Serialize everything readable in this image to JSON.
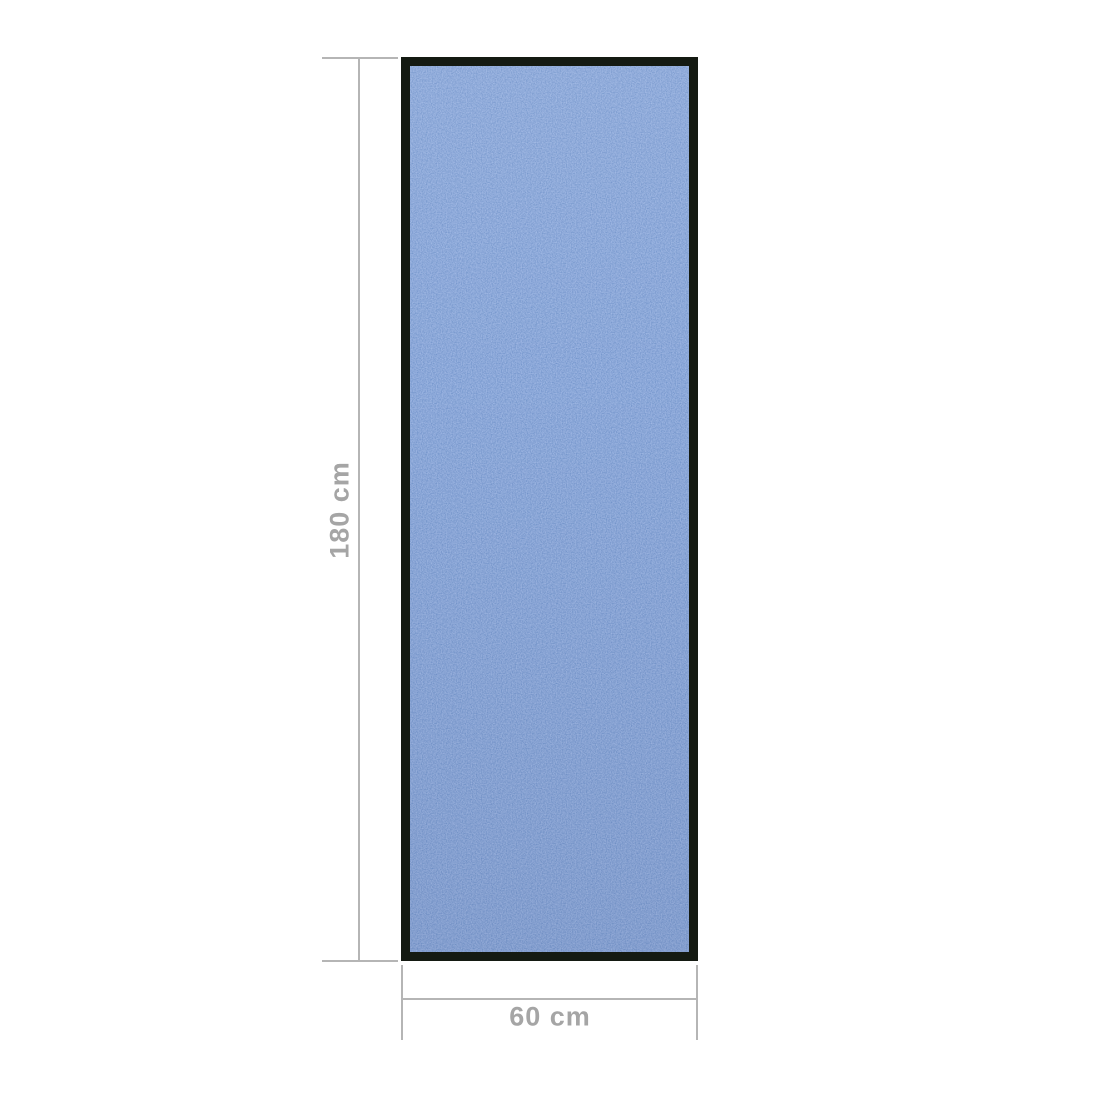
{
  "product": {
    "type": "doormat-runner",
    "orientation": "vertical"
  },
  "dimensions": {
    "height": {
      "label": "180 cm",
      "value_cm": 180
    },
    "width": {
      "label": "60 cm",
      "value_cm": 60
    }
  },
  "colors": {
    "background": "#ffffff",
    "mat_blue": "#3a62b4",
    "mat_border": "#141a12",
    "line_gray": "#b5b5b5",
    "label_gray": "#a5a5a5"
  }
}
